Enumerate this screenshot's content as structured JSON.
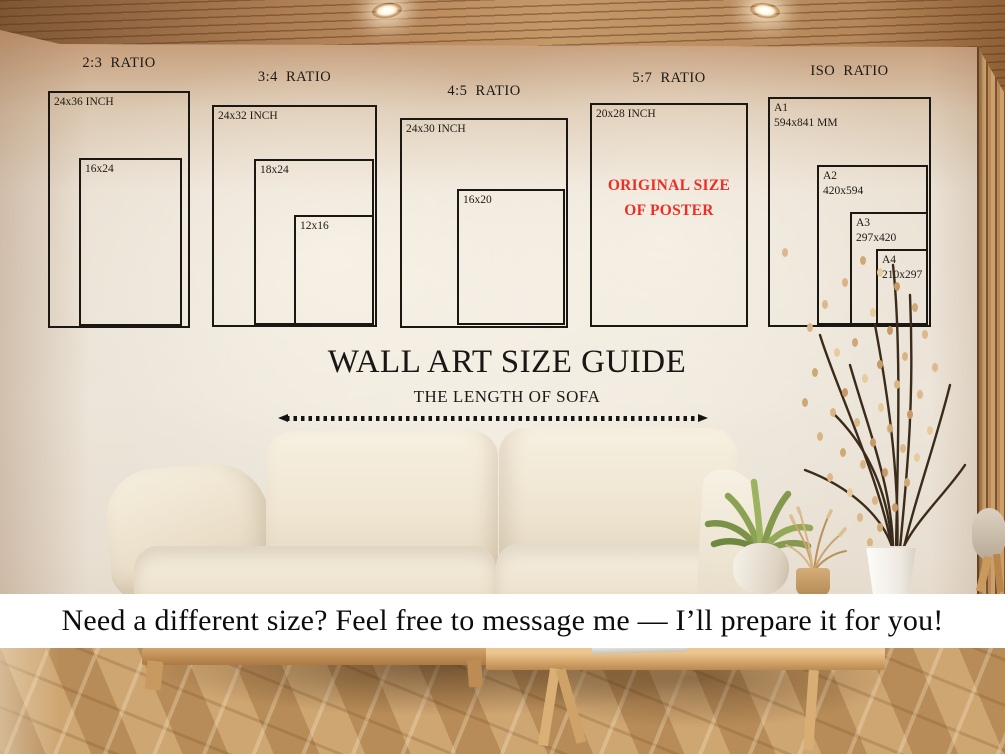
{
  "headline": {
    "title": "WALL ART SIZE GUIDE",
    "subtitle": "THE LENGTH OF SOFA"
  },
  "banner": {
    "text": "Need a different size? Feel free to message me — I’ll prepare it for you!"
  },
  "size_guide": {
    "groups": [
      {
        "title": "2:3 RATIO",
        "outer": "24x36 INCH",
        "inner1": "16x24"
      },
      {
        "title": "3:4 RATIO",
        "outer": "24x32 INCH",
        "inner1": "18x24",
        "inner2": "12x16"
      },
      {
        "title": "4:5 RATIO",
        "outer": "24x30 INCH",
        "inner1": "16x20"
      },
      {
        "title": "5:7 RATIO",
        "outer": "20x28 INCH",
        "note1": "ORIGINAL SIZE",
        "note2": "OF POSTER"
      },
      {
        "title": "ISO RATIO",
        "a1_name": "A1",
        "a1_dims": "594x841 MM",
        "a2_name": "A2",
        "a2_dims": "420x594",
        "a3_name": "A3",
        "a3_dims": "297x420",
        "a4_name": "A4",
        "a4_dims": "210x297"
      }
    ]
  },
  "colors": {
    "accent_red": "#ee2e24",
    "frame_line": "#1b1712",
    "banner_bg": "#ffffff"
  }
}
